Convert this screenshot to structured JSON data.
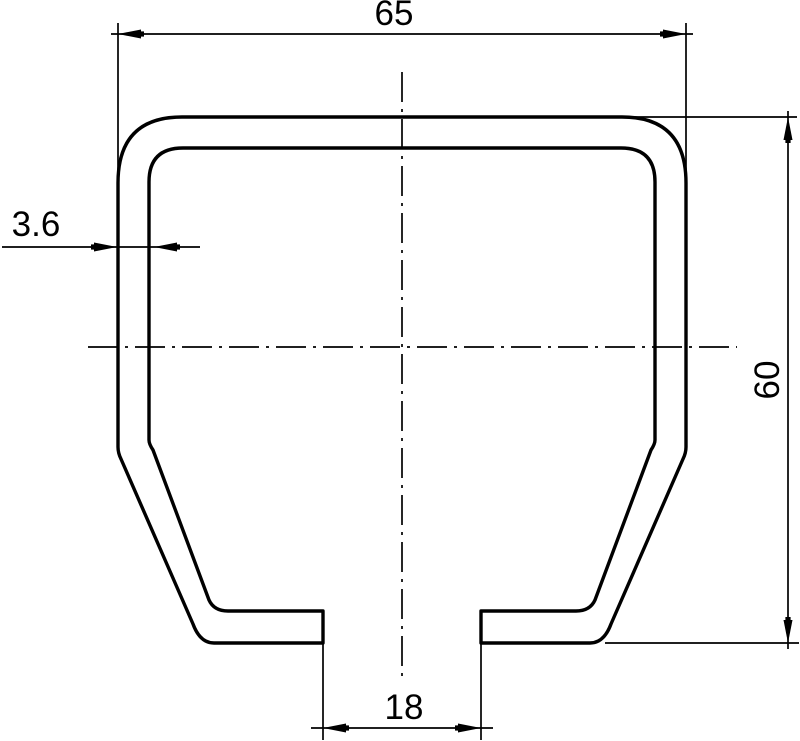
{
  "drawing": {
    "title": "channel-profile-cross-section",
    "dimensions": {
      "width_top": "65",
      "wall_thickness": "3.6",
      "height_right": "60",
      "slot_width_bottom": "18"
    },
    "colors": {
      "line": "#000000",
      "background": "#ffffff"
    }
  }
}
